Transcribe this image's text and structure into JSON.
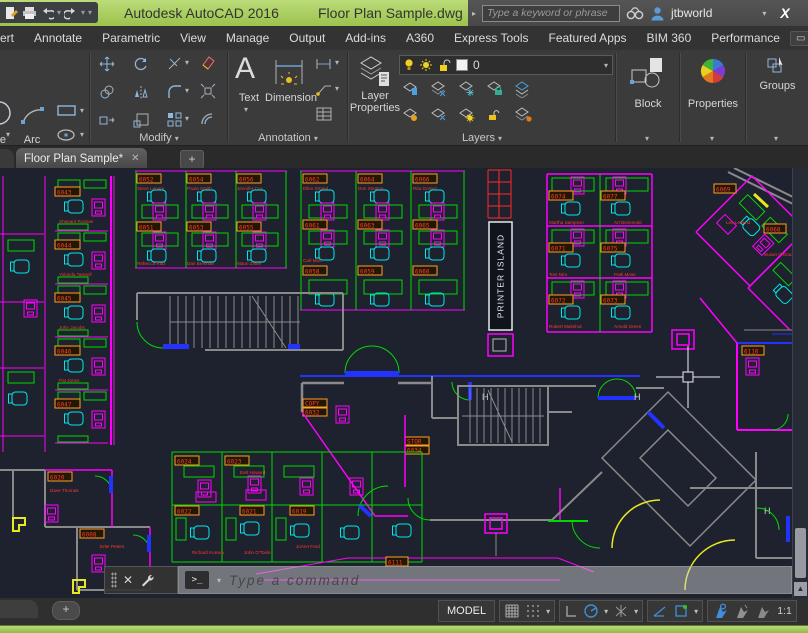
{
  "titlebar": {
    "app_title": "Autodesk AutoCAD 2016",
    "doc_title": "Floor Plan Sample.dwg",
    "search_placeholder": "Type a keyword or phrase",
    "username": "jtbworld",
    "exchange_label": "X"
  },
  "ribbon": {
    "tabs": [
      "Insert",
      "Annotate",
      "Parametric",
      "View",
      "Manage",
      "Output",
      "Add-ins",
      "A360",
      "Express Tools",
      "Featured Apps",
      "BIM 360",
      "Performance"
    ],
    "draw": {
      "circle_label": "Circle",
      "arc_label": "Arc"
    },
    "modify_label": "Modify",
    "annotation": {
      "panel_label": "Annotation",
      "text_label": "Text",
      "dimension_label": "Dimension"
    },
    "layers": {
      "panel_label": "Layers",
      "layer_properties_line1": "Layer",
      "layer_properties_line2": "Properties",
      "current_layer": "0"
    },
    "block_label": "Block",
    "properties_label": "Properties",
    "groups_label": "Groups"
  },
  "filetabs": {
    "active_tab": "Floor Plan Sample*"
  },
  "commandline": {
    "placeholder": "Type a command"
  },
  "statusbar": {
    "model_label": "MODEL",
    "annotation_scale": "1:1"
  },
  "floorplan": {
    "printer_island_label": "PRINTER ISLAND",
    "tags": [
      "6043",
      "6044",
      "6045",
      "6046",
      "6047",
      "6052",
      "6054",
      "6056",
      "6051",
      "6053",
      "6055",
      "6062",
      "6064",
      "6066",
      "6061",
      "6063",
      "6065",
      "6058",
      "6059",
      "6060",
      "6074",
      "6077",
      "6071",
      "6075",
      "6072",
      "6073",
      "6069",
      "6068",
      "6110",
      "COPY",
      "6032",
      "STOR",
      "6034",
      "6020",
      "6008",
      "6024",
      "6023",
      "6022",
      "6021",
      "6019",
      "6111"
    ],
    "names": [
      "Shepard Romias",
      "Yolanda Tartanif",
      "John Jacobs",
      "Pat Jones",
      "Steve Lenare",
      "Paula Smith",
      "Jennifer Cox",
      "Rebecca Ruiz",
      "Dan Brennan",
      "Mauri Zinke",
      "Ellen Strand",
      "Don Stanton",
      "Rita Gomez",
      "Carl Mott",
      "Martha Sampson",
      "Art Bezemold",
      "Toni Niro",
      "Patti Mose",
      "Robert Malmhot",
      "Arnold Green",
      "Lee Ledend",
      "Susan O'Grady",
      "Dave Thomas",
      "Erler Peters",
      "Earl Howard",
      "Richard Kumea",
      "John O'Toole",
      "JoAnn Ford"
    ]
  }
}
